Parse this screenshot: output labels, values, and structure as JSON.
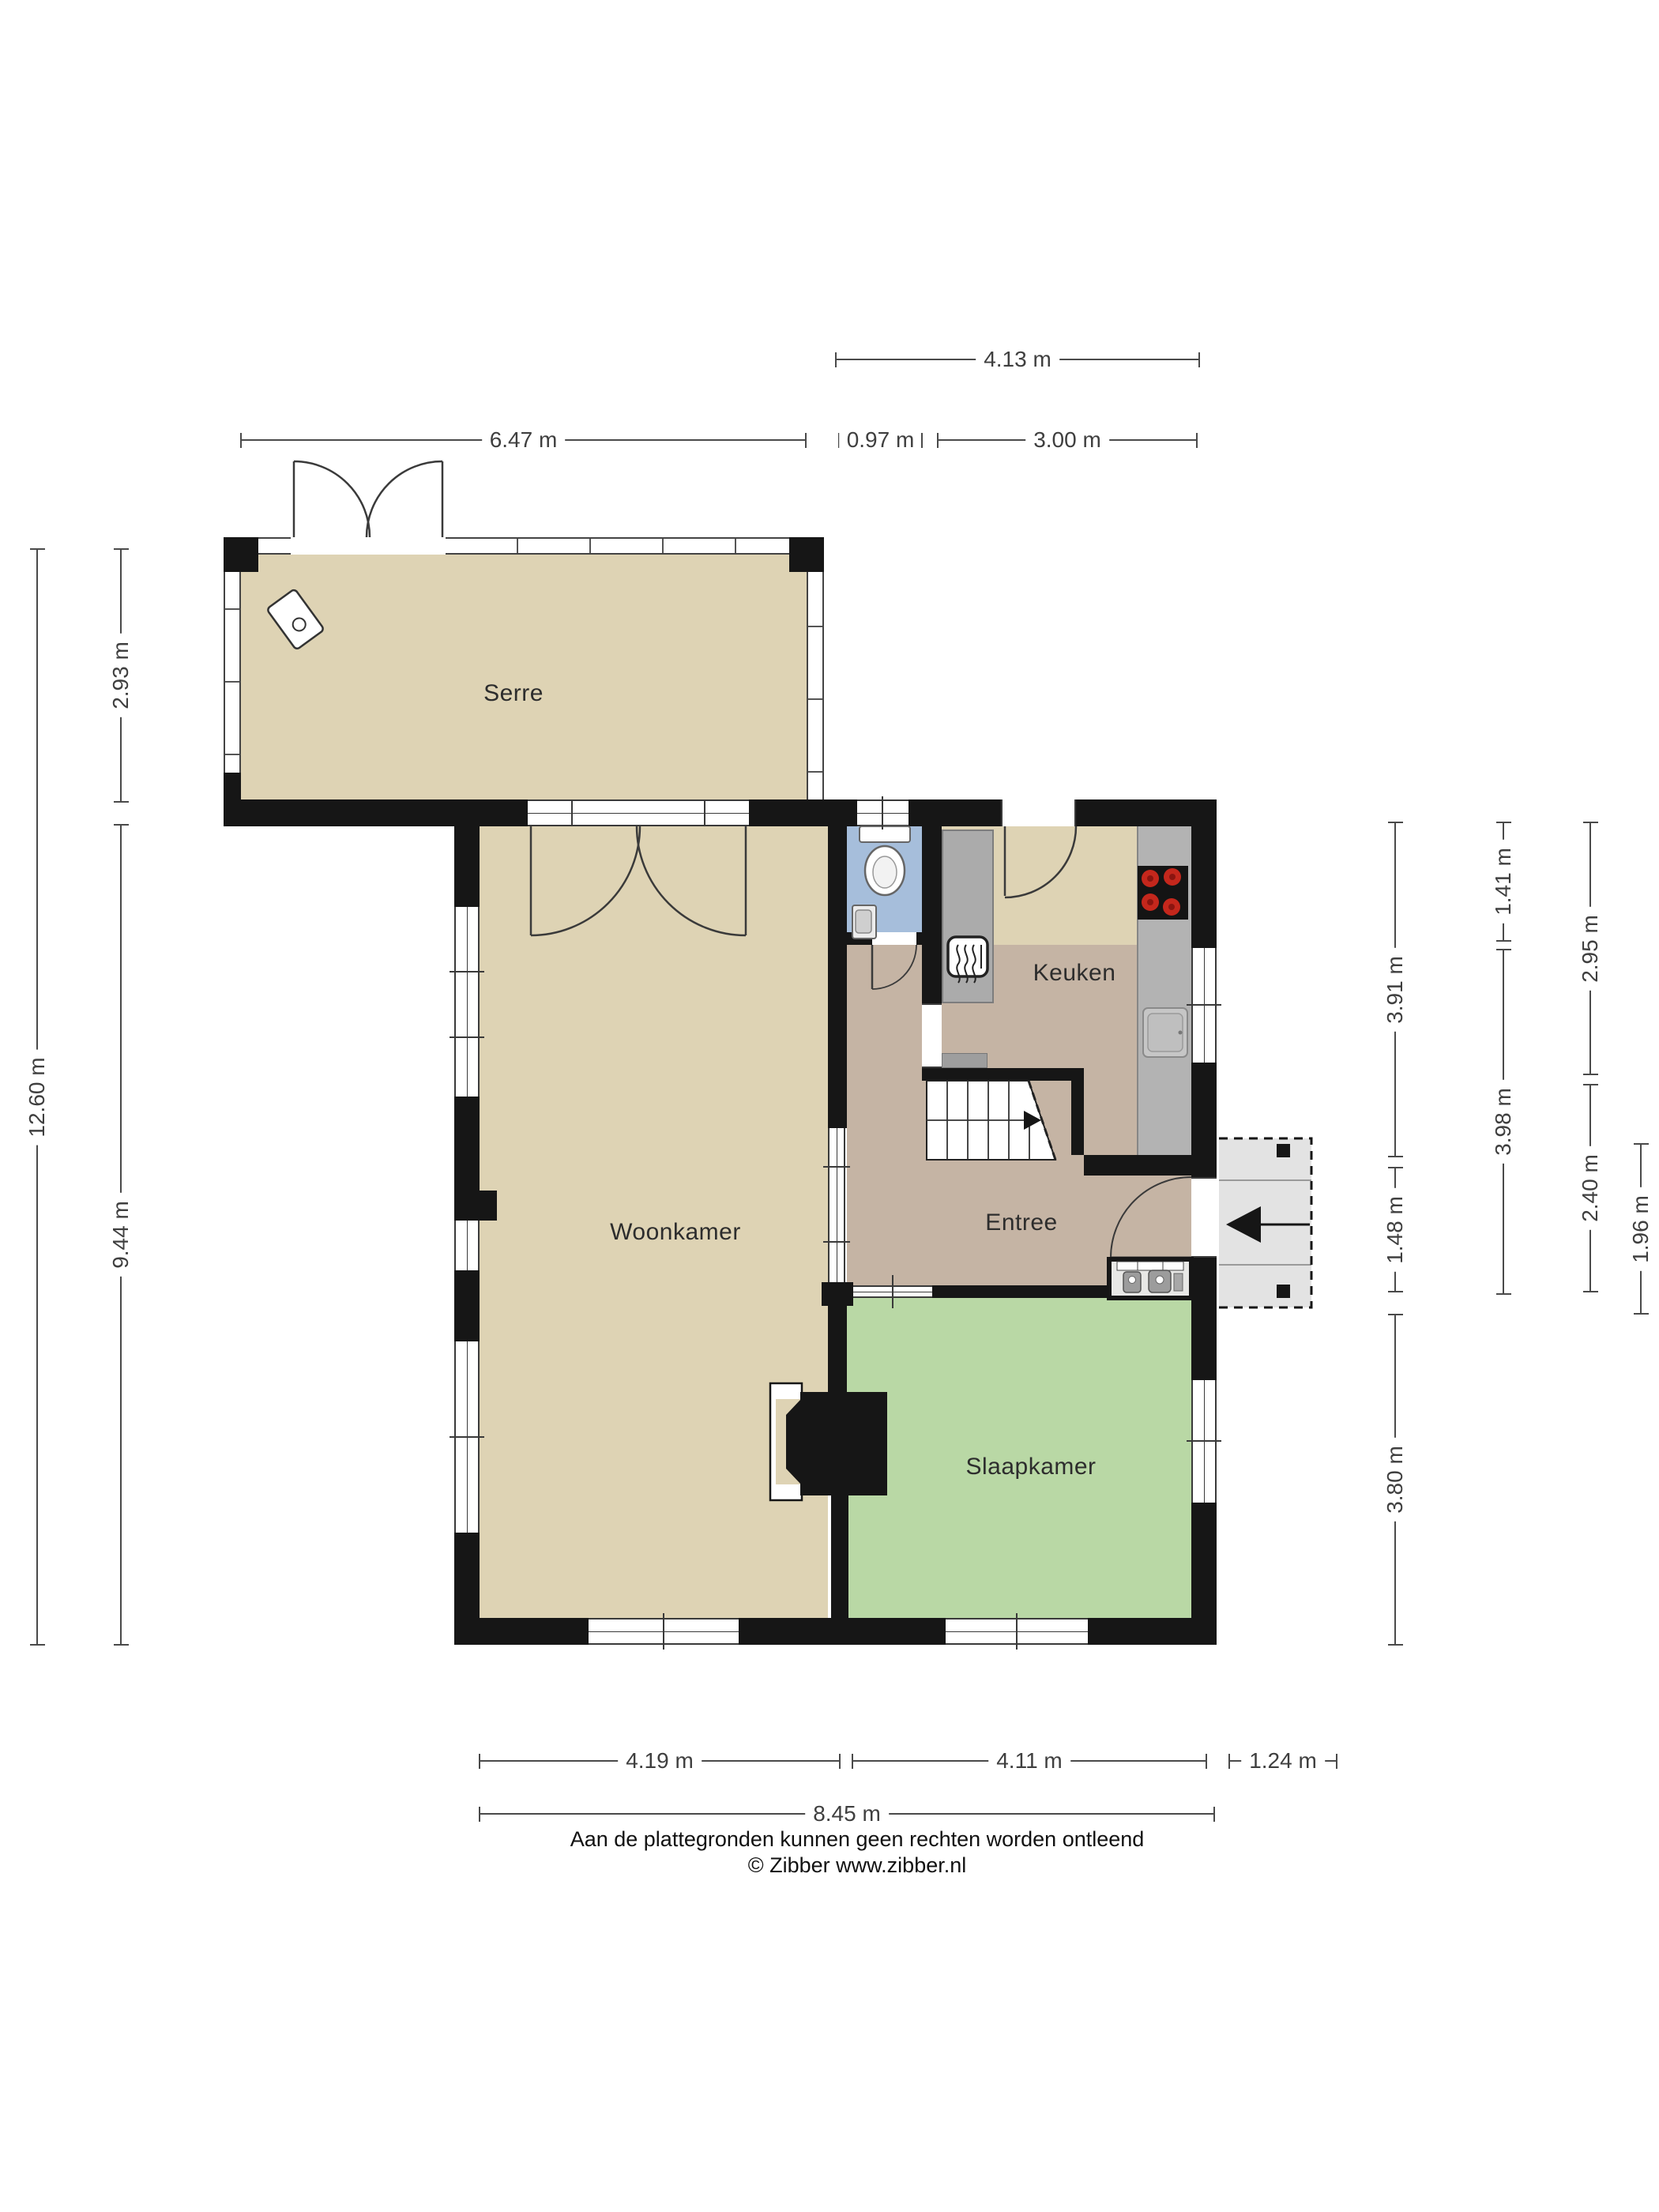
{
  "rooms": {
    "serre": "Serre",
    "woonkamer": "Woonkamer",
    "keuken": "Keuken",
    "entree": "Entree",
    "slaapkamer": "Slaapkamer"
  },
  "dimensions": {
    "top_row1": [
      {
        "label": "4.13 m"
      }
    ],
    "top_row2": [
      {
        "label": "6.47 m"
      },
      {
        "label": "0.97 m"
      },
      {
        "label": "3.00 m"
      }
    ],
    "left": [
      {
        "label": "2.93 m"
      },
      {
        "label": "12.60 m"
      },
      {
        "label": "9.44 m"
      }
    ],
    "right": [
      {
        "label": "3.91 m"
      },
      {
        "label": "1.48 m"
      },
      {
        "label": "3.80 m"
      },
      {
        "label": "1.41 m"
      },
      {
        "label": "3.98 m"
      },
      {
        "label": "2.95 m"
      },
      {
        "label": "2.40 m"
      },
      {
        "label": "1.96 m"
      }
    ],
    "bottom_row1": [
      {
        "label": "4.19 m"
      },
      {
        "label": "4.11 m"
      },
      {
        "label": "1.24 m"
      }
    ],
    "bottom_row2": [
      {
        "label": "8.45 m"
      }
    ]
  },
  "footer": {
    "line1": "Aan de plattegronden kunnen geen rechten worden ontleend",
    "line2": "© Zibber www.zibber.nl"
  },
  "colors": {
    "wall": "#161616",
    "room_beige": "#ded3b4",
    "entree_taupe": "#c5b4a4",
    "slaapkamer_green": "#b9d8a5",
    "toilet_blue": "#a6bedb",
    "porch_gray": "#e3e3e3",
    "counter_gray": "#b3b3b3",
    "cabinet_gray": "#ababab",
    "cooktop_black": "#141414",
    "burner_red": "#c4271c",
    "dimension_line": "#4a4a4a"
  }
}
